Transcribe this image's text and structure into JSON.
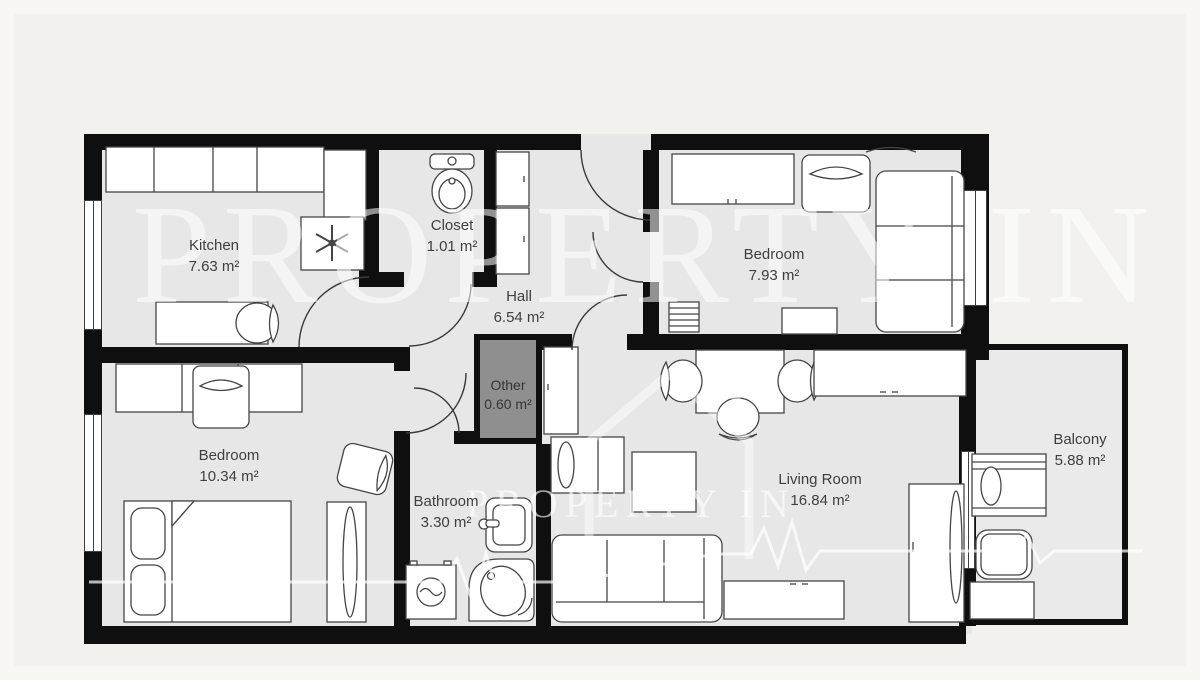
{
  "floorplan": {
    "watermark": {
      "text": "PROPERTY IN",
      "text_small": "PROPERTY IN"
    },
    "rooms": {
      "kitchen": {
        "name": "Kitchen",
        "area": "7.63 m²"
      },
      "closet": {
        "name": "Closet",
        "area": "1.01 m²"
      },
      "hall": {
        "name": "Hall",
        "area": "6.54 m²"
      },
      "bedroom_small": {
        "name": "Bedroom",
        "area": "7.93 m²"
      },
      "bedroom_large": {
        "name": "Bedroom",
        "area": "10.34 m²"
      },
      "other": {
        "name": "Other",
        "area": "0.60 m²"
      },
      "bathroom": {
        "name": "Bathroom",
        "area": "3.30 m²"
      },
      "living_room": {
        "name": "Living Room",
        "area": "16.84 m²"
      },
      "balcony": {
        "name": "Balcony",
        "area": "5.88 m²"
      }
    },
    "colors": {
      "wall": "#0f0f0f",
      "floor": "#e8e7e7",
      "other_fill": "#8f8f8f",
      "background": "#f2f1ed",
      "furniture_stroke": "#454545"
    }
  }
}
